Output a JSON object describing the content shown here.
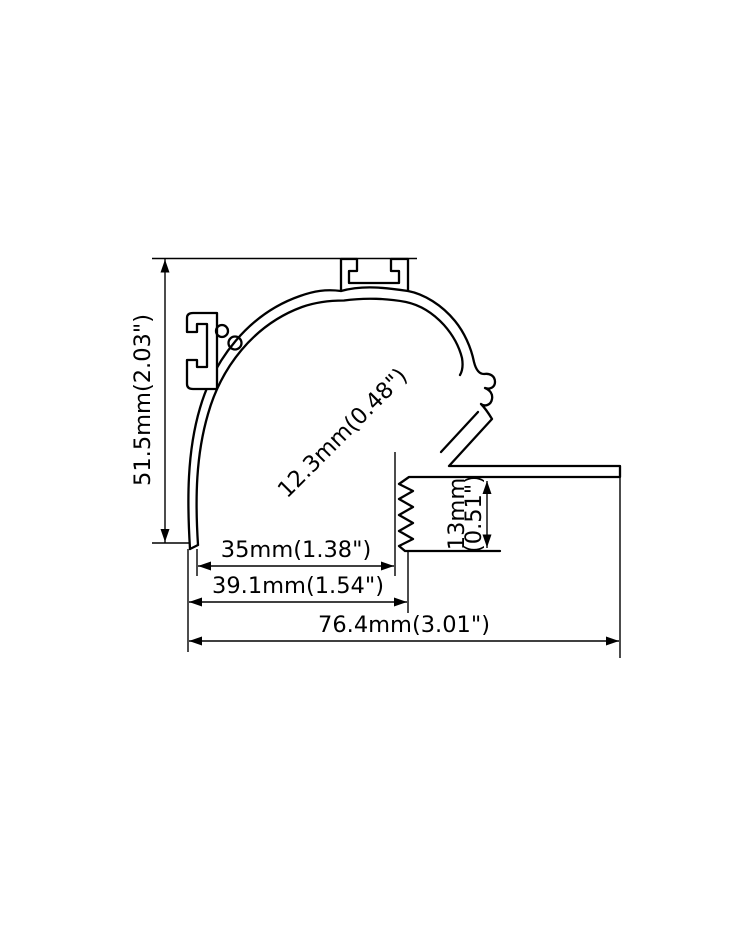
{
  "drawing": {
    "title": "led-profile-cross-section",
    "line_color": "#000000",
    "background_color": "#ffffff",
    "dimensions": {
      "overall_height": "51.5mm(2.03\")",
      "led_slot_width": "12.3mm(0.48\")",
      "inner_width": "35mm(1.38\")",
      "recess_width": "39.1mm(1.54\")",
      "overall_width": "76.4mm(3.01\")",
      "wall_thickness_mm": "13mm",
      "wall_thickness_in": "(0.51\")"
    }
  }
}
